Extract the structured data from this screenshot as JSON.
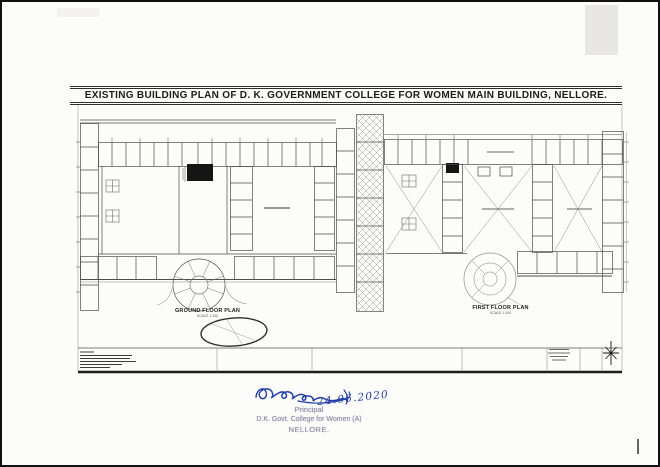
{
  "sheet": {
    "title": "EXISTING BUILDING PLAN OF D. K. GOVERNMENT COLLEGE FOR WOMEN  MAIN BUILDING, NELLORE."
  },
  "plans": {
    "ground_floor": {
      "label": "GROUND FLOOR PLAN",
      "scale_note": "SCALE 1:100"
    },
    "first_floor": {
      "label": "FIRST FLOOR PLAN",
      "scale_note": "SCALE 1:100"
    }
  },
  "approval": {
    "handwritten_date": "24.06.2020",
    "stamp": {
      "line1": "Principal",
      "line2": "D.K. Govt. College for Women (A)",
      "line3": "NELLORE."
    }
  },
  "colors": {
    "drawing_ink": "#4e4e4e",
    "signature_ink": "#2540a8",
    "stamp_ink": "#8e87a3",
    "paper": "#fcfcfa"
  }
}
